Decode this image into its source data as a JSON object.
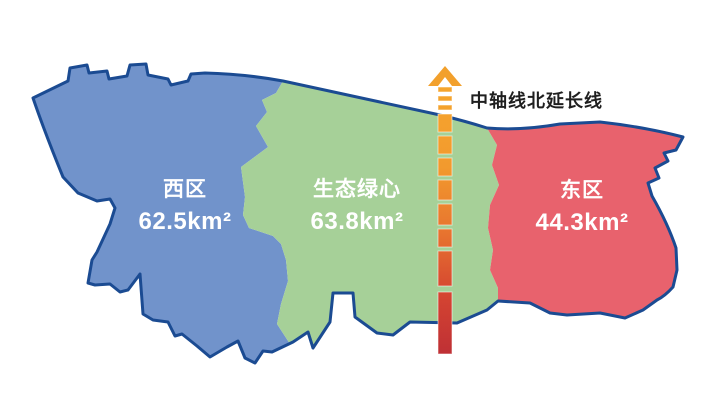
{
  "map": {
    "background": "#FFFFFF",
    "outline_color": "#1B4B92",
    "regions": [
      {
        "name": "西区",
        "area": "62.5km²",
        "fill": "#7193CB",
        "label_color": "#FFFFFF"
      },
      {
        "name": "生态绿心",
        "area": "63.8km²",
        "fill": "#A6D098",
        "label_color": "#FFFFFF"
      },
      {
        "name": "东区",
        "area": "44.3km²",
        "fill": "#E8626D",
        "label_color": "#FFFFFF"
      }
    ]
  },
  "axis": {
    "label": "中轴线北延长线",
    "label_color": "#1F1F1F",
    "arrow_color": "#F2A02C",
    "gradient": [
      "#F5A52D",
      "#F29A2E",
      "#E7732F",
      "#D44431",
      "#BF3035"
    ]
  }
}
